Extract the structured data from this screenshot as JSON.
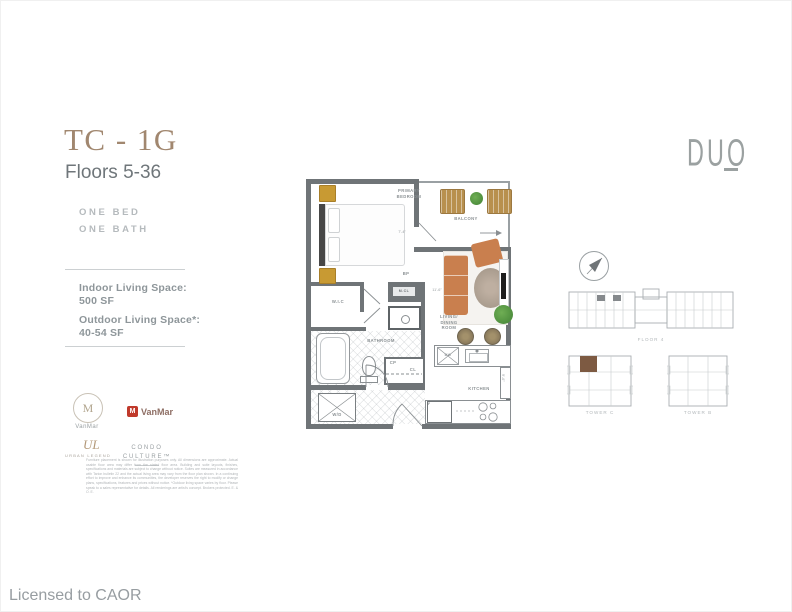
{
  "header": {
    "unit_code": "TC - 1G",
    "floors": "Floors 5-36"
  },
  "brand": {
    "name": "DUO"
  },
  "specs": {
    "config_text": "ONE BED\nONE BATH",
    "indoor_label": "Indoor Living Space:",
    "indoor_value": "500 SF",
    "outdoor_label": "Outdoor Living Space*:",
    "outdoor_value": "40-54 SF"
  },
  "partners": {
    "vanmar_monogram": "M",
    "vanmar_name": "VanMar",
    "vanmar_red_icon": "M",
    "vanmar_red_name": "VanMar",
    "urban_monogram": "UL",
    "urban_name": "URBAN LEGEND",
    "condo_culture": "CONDO\nCULTURE™"
  },
  "disclaimer": "Furniture placement is shown for illustration purposes only. All dimensions are approximate. Actual usable floor area may differ from the stated floor area. Building and suite layouts, finishes, specifications and materials are subject to change without notice. Suites are measured in accordance with Tarion bulletin 22 and the actual living area may vary from the floor plan shown. In a continuing effort to improve and enhance its communities, the developer reserves the right to modify or change plans, specifications, features and prices without notice. *Outdoor living space varies by floor. Please speak to a sales representative for details. All renderings are artist's concept. Brokers protected. E. & O. E.",
  "footer": {
    "license": "Licensed to CAOR"
  },
  "floorplan": {
    "labels": {
      "primary_bedroom": "PRIMARY\nBEDROOM",
      "balcony": "BALCONY",
      "wic": "W.I.C",
      "bp": "BP",
      "mcl": "M.CL",
      "bathroom": "BATHROOM",
      "cp": "CP",
      "cl": "CL",
      "wd": "W/D",
      "living": "LIVING/\nDINING\nROOM",
      "kitchen": "KITCHEN",
      "dw": "DW",
      "fridge": "F"
    },
    "dimensions": {
      "d1": "7'-4\"",
      "d2": "11'-6\"",
      "d3": "9'-6\""
    }
  },
  "keyplans": {
    "floor_label": "FLOOR 4",
    "tower_left_label": "TOWER C",
    "tower_right_label": "TOWER B"
  },
  "colors": {
    "accent_brown": "#a1876f",
    "wall_gray": "#6f7477",
    "suite_highlight": "#7d5a42",
    "sofa_orange": "#c97f4e",
    "nightstand_gold": "#c89a33",
    "vanmar_red": "#c0392b",
    "plant_green": "#4f8f3e"
  }
}
